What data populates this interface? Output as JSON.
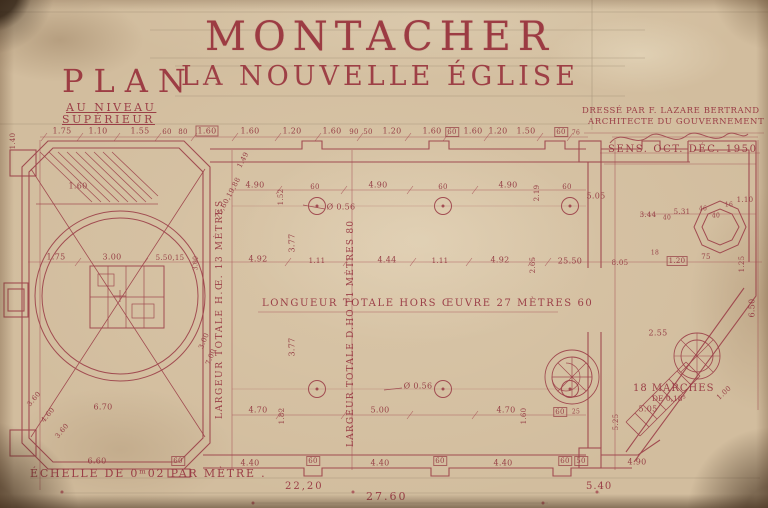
{
  "title": {
    "main": "MONTACHER",
    "sub": "LA NOUVELLE ÉGLISE"
  },
  "plan_block": {
    "word": "PLAN",
    "level1": "AU NIVEAU",
    "level2": "SUPÉRIEUR"
  },
  "stamp": {
    "drafted_by": "DRESSÉ PAR F. LAZARE BERTRAND",
    "role": "ARCHITECTE DU GOUVERNEMENT",
    "date": "SENS. OCT. DÉC. 1950"
  },
  "annotations": {
    "length_total": "LONGUEUR TOTALE HORS ŒUVRE 27 MÈTRES 60",
    "width_total_hors": "LARGEUR TOTALE H.Œ. 13 MÈTRES",
    "width_total_dans": "LARGEUR TOTALE D.HO 11 MÈTRES 80",
    "stairs_line1": "18 MARCHES",
    "stairs_line2": "DE 0,18⁵",
    "scale": "ÉCHELLE DE 0ᵐ02 PAR MÈTRE ."
  },
  "totals": {
    "partial": "22,20",
    "overall": "27.60",
    "east": "5.40"
  },
  "ink_color": "#9c3e48",
  "paper_color": "#d2bd9e",
  "dims": [
    {
      "t": "1.75",
      "x": 62,
      "y": 131
    },
    {
      "t": "1.10",
      "x": 98,
      "y": 131
    },
    {
      "t": "1.55",
      "x": 140,
      "y": 131
    },
    {
      "t": "60",
      "x": 167,
      "y": 132,
      "s": 7
    },
    {
      "t": "80",
      "x": 183,
      "y": 132,
      "s": 7
    },
    {
      "t": "1.60",
      "x": 207,
      "y": 131,
      "box": true
    },
    {
      "t": "1.60",
      "x": 250,
      "y": 131
    },
    {
      "t": "1.20",
      "x": 292,
      "y": 131
    },
    {
      "t": "1.60",
      "x": 332,
      "y": 131
    },
    {
      "t": "90",
      "x": 354,
      "y": 132,
      "s": 7
    },
    {
      "t": "50",
      "x": 368,
      "y": 132,
      "s": 7
    },
    {
      "t": "1.20",
      "x": 392,
      "y": 131
    },
    {
      "t": "1.60",
      "x": 432,
      "y": 131
    },
    {
      "t": "60",
      "x": 452,
      "y": 132,
      "s": 7,
      "box": true
    },
    {
      "t": "1.60",
      "x": 473,
      "y": 131
    },
    {
      "t": "1.20",
      "x": 498,
      "y": 131
    },
    {
      "t": "1.50",
      "x": 526,
      "y": 131
    },
    {
      "t": "60",
      "x": 561,
      "y": 132,
      "s": 7,
      "box": true
    },
    {
      "t": "76",
      "x": 576,
      "y": 133,
      "s": 6
    },
    {
      "t": "1.40",
      "x": 13,
      "y": 141,
      "r": -90,
      "s": 7
    },
    {
      "t": "1.60",
      "x": 78,
      "y": 186
    },
    {
      "t": "4.90",
      "x": 255,
      "y": 185
    },
    {
      "t": "60",
      "x": 315,
      "y": 187,
      "s": 7
    },
    {
      "t": "4.90",
      "x": 378,
      "y": 185
    },
    {
      "t": "60",
      "x": 443,
      "y": 187,
      "s": 7
    },
    {
      "t": "4.90",
      "x": 508,
      "y": 185
    },
    {
      "t": "60",
      "x": 567,
      "y": 187,
      "s": 7
    },
    {
      "t": "1.52",
      "x": 281,
      "y": 197,
      "r": -90,
      "s": 7
    },
    {
      "t": "2.19",
      "x": 537,
      "y": 193,
      "r": -90,
      "s": 7
    },
    {
      "t": "5.05",
      "x": 596,
      "y": 196
    },
    {
      "t": "3.44",
      "x": 648,
      "y": 215,
      "s": 7
    },
    {
      "t": "40",
      "x": 667,
      "y": 218,
      "s": 6
    },
    {
      "t": "5.31",
      "x": 682,
      "y": 212,
      "s": 7
    },
    {
      "t": "46",
      "x": 703,
      "y": 209,
      "s": 6
    },
    {
      "t": "40",
      "x": 716,
      "y": 216,
      "s": 6
    },
    {
      "t": "16",
      "x": 729,
      "y": 205,
      "s": 6
    },
    {
      "t": "1.10",
      "x": 745,
      "y": 200,
      "s": 7
    },
    {
      "t": "1.49",
      "x": 243,
      "y": 160,
      "r": -62,
      "s": 7
    },
    {
      "t": "75,60,19,88",
      "x": 228,
      "y": 198,
      "r": -62,
      "s": 7
    },
    {
      "t": "1.75",
      "x": 56,
      "y": 257
    },
    {
      "t": "3.00",
      "x": 112,
      "y": 257
    },
    {
      "t": "5.50,15",
      "x": 170,
      "y": 258,
      "s": 7
    },
    {
      "t": "3.00",
      "x": 196,
      "y": 263,
      "r": -90,
      "s": 6
    },
    {
      "t": "4.92",
      "x": 258,
      "y": 259
    },
    {
      "t": "1.11",
      "x": 317,
      "y": 261,
      "s": 7
    },
    {
      "t": "4.44",
      "x": 387,
      "y": 260
    },
    {
      "t": "1.11",
      "x": 440,
      "y": 261,
      "s": 7
    },
    {
      "t": "4.92",
      "x": 500,
      "y": 260
    },
    {
      "t": "2.65",
      "x": 533,
      "y": 265,
      "r": -90,
      "s": 7
    },
    {
      "t": "25.50",
      "x": 570,
      "y": 261
    },
    {
      "t": "8.05",
      "x": 620,
      "y": 263,
      "s": 7
    },
    {
      "t": "18",
      "x": 655,
      "y": 253,
      "s": 6
    },
    {
      "t": "1.20",
      "x": 677,
      "y": 261,
      "s": 7,
      "box": true
    },
    {
      "t": "75",
      "x": 706,
      "y": 257,
      "s": 7
    },
    {
      "t": "1.25",
      "x": 742,
      "y": 264,
      "r": -90,
      "s": 7
    },
    {
      "t": "Ø 0.56",
      "x": 341,
      "y": 207
    },
    {
      "t": "Ø 0.56",
      "x": 418,
      "y": 386
    },
    {
      "t": "3.77",
      "x": 292,
      "y": 243,
      "r": -90
    },
    {
      "t": "3.77",
      "x": 292,
      "y": 347,
      "r": -90
    },
    {
      "t": "3.00",
      "x": 204,
      "y": 341,
      "r": -68,
      "s": 7
    },
    {
      "t": "7.00",
      "x": 211,
      "y": 357,
      "r": -68,
      "s": 7
    },
    {
      "t": "3.60",
      "x": 34,
      "y": 399,
      "r": -50,
      "s": 7
    },
    {
      "t": "4.60",
      "x": 48,
      "y": 415,
      "r": -50,
      "s": 7
    },
    {
      "t": "3.60",
      "x": 62,
      "y": 431,
      "r": -50,
      "s": 7
    },
    {
      "t": "2.55",
      "x": 658,
      "y": 333
    },
    {
      "t": "6.50",
      "x": 752,
      "y": 308,
      "r": -90
    },
    {
      "t": "5.25",
      "x": 616,
      "y": 422,
      "r": -90,
      "s": 7
    },
    {
      "t": "5.05",
      "x": 648,
      "y": 409
    },
    {
      "t": "1.00",
      "x": 724,
      "y": 393,
      "r": -42,
      "s": 7
    },
    {
      "t": "6.70",
      "x": 103,
      "y": 407
    },
    {
      "t": "4.70",
      "x": 258,
      "y": 410
    },
    {
      "t": "1.82",
      "x": 282,
      "y": 416,
      "r": -90,
      "s": 7
    },
    {
      "t": "5.00",
      "x": 380,
      "y": 410
    },
    {
      "t": "4.70",
      "x": 506,
      "y": 410
    },
    {
      "t": "1.60",
      "x": 524,
      "y": 416,
      "r": -90,
      "s": 7
    },
    {
      "t": "60",
      "x": 560,
      "y": 412,
      "s": 7,
      "box": true
    },
    {
      "t": "25",
      "x": 576,
      "y": 412,
      "s": 6
    },
    {
      "t": "6.60",
      "x": 97,
      "y": 461
    },
    {
      "t": "60",
      "x": 178,
      "y": 461,
      "s": 7,
      "box": true
    },
    {
      "t": "4.40",
      "x": 250,
      "y": 463
    },
    {
      "t": "60",
      "x": 313,
      "y": 461,
      "s": 7,
      "box": true
    },
    {
      "t": "4.40",
      "x": 380,
      "y": 463
    },
    {
      "t": "60",
      "x": 440,
      "y": 461,
      "s": 7,
      "box": true
    },
    {
      "t": "4.40",
      "x": 503,
      "y": 463
    },
    {
      "t": "60",
      "x": 565,
      "y": 461,
      "s": 7,
      "box": true
    },
    {
      "t": "50",
      "x": 581,
      "y": 461,
      "s": 7,
      "box": true
    },
    {
      "t": "4.90",
      "x": 637,
      "y": 462
    }
  ]
}
